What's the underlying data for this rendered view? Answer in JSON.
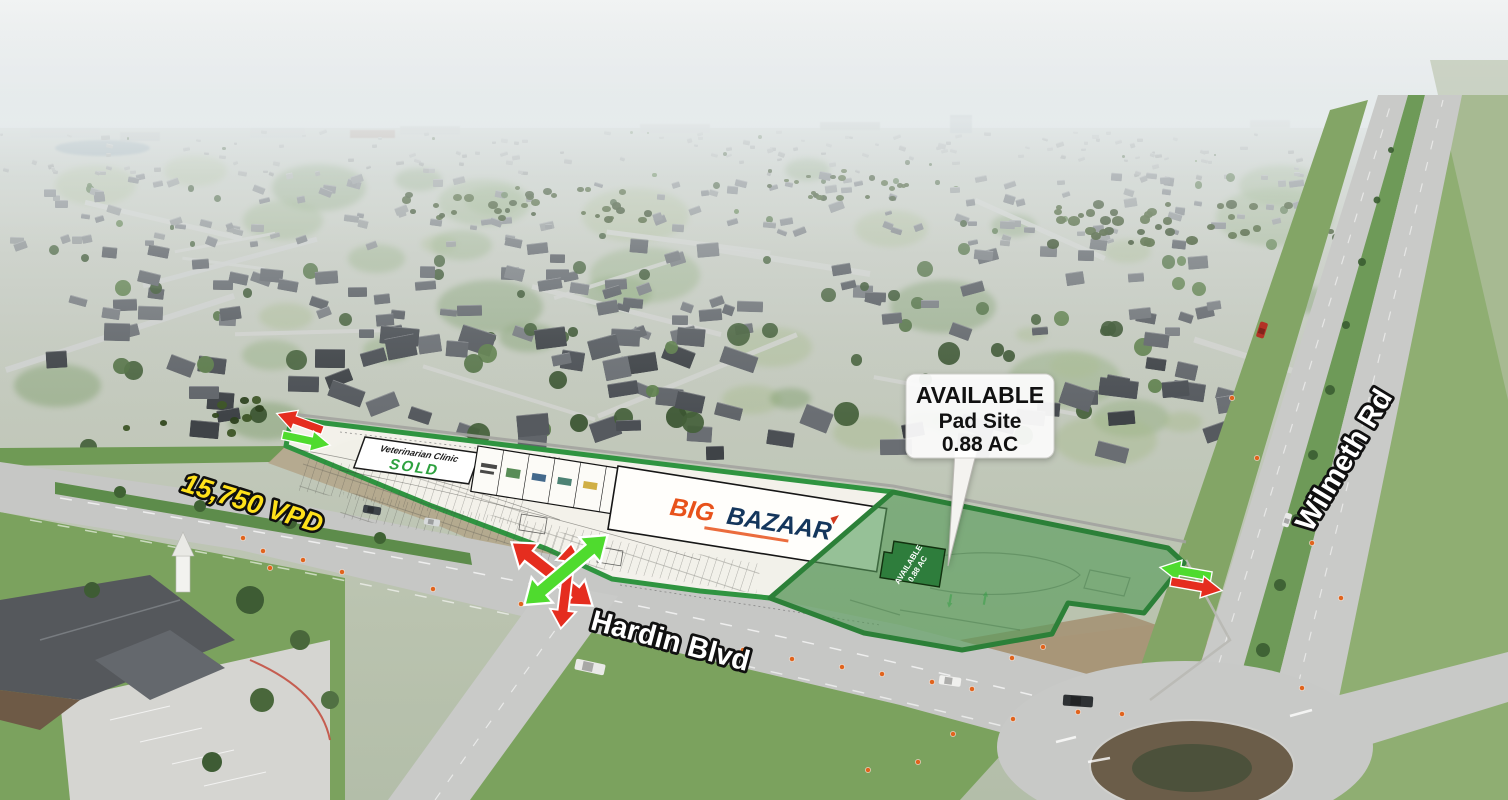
{
  "labels": {
    "traffic_count": "15,750 VPD",
    "road_primary": "Hardin Blvd",
    "road_secondary": "Wilmeth Rd"
  },
  "callout": {
    "line1": "AVAILABLE",
    "line2": "Pad Site",
    "line3": "0.88 AC"
  },
  "pad_site": {
    "line1": "AVAILABLE",
    "line2": "0.88 AC"
  },
  "vet_pad": {
    "name": "Veterinarian Clinic",
    "status": "SOLD"
  },
  "anchor_tenant": {
    "name_part1": "BIG",
    "name_part2": "BAZAAR"
  },
  "colors": {
    "site_outline_green": "#2f9440",
    "pad_fill_green": "#559b58",
    "footprint_green": "#2e7d3c",
    "arrow_red": "#e52d1f",
    "arrow_green": "#4fdb2e",
    "traffic_label_yellow": "#ffe11a",
    "sold_green": "#2ea13f",
    "brand_orange": "#e8521b",
    "brand_navy": "#14365c",
    "callout_bg": "#ffffff"
  }
}
